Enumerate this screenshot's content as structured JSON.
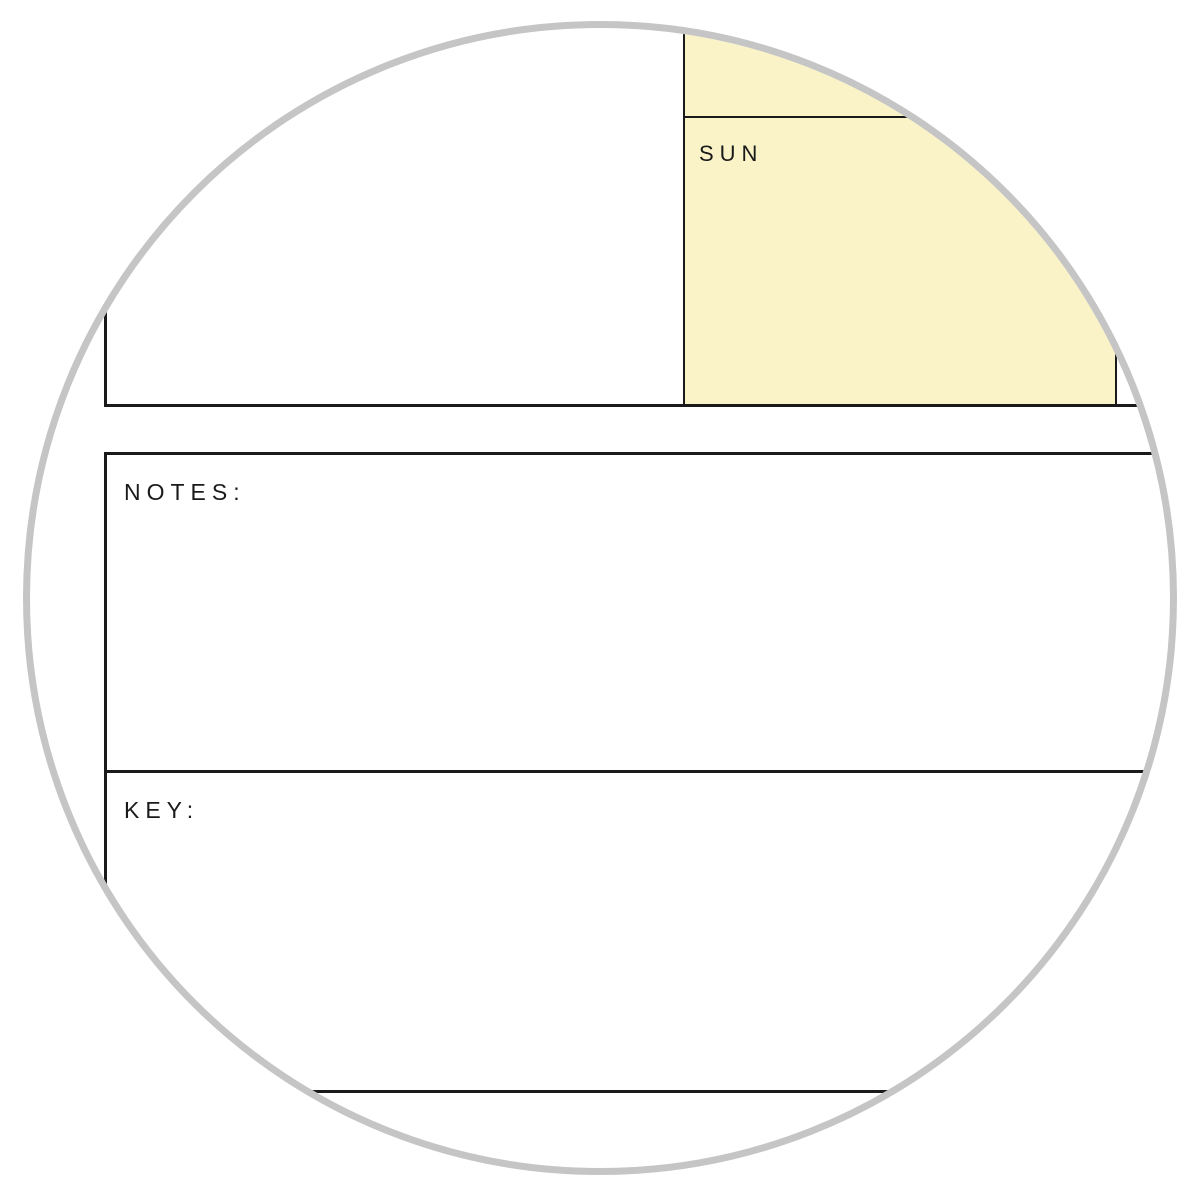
{
  "calendar": {
    "day_label": "SUN"
  },
  "notes": {
    "label": "NOTES:"
  },
  "key": {
    "label": "KEY:"
  },
  "colors": {
    "highlight_yellow": "#FAF3C8",
    "line_black": "#1A1A1A",
    "circle_gray": "#C5C5C5"
  }
}
